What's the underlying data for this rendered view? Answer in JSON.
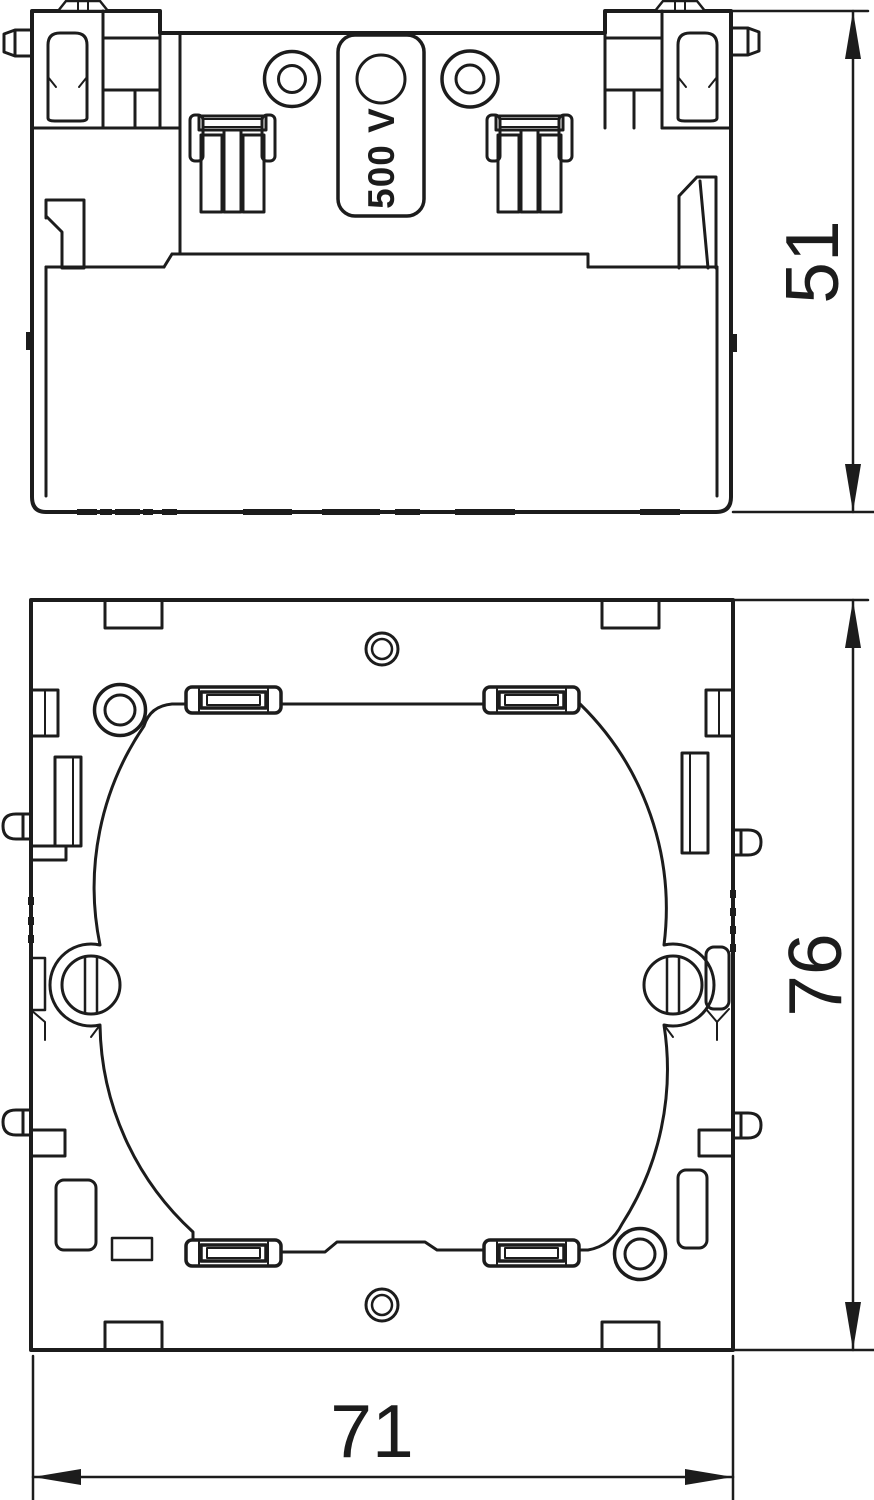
{
  "drawing": {
    "kind": "technical-dimension-drawing",
    "colors": {
      "line": "#1c1c1c",
      "background": "#ffffff"
    }
  },
  "views": {
    "side": {
      "name": "side-elevation-view",
      "voltage_label": "500 V",
      "height_dimension": "51"
    },
    "front": {
      "name": "front-plan-view",
      "height_dimension": "76",
      "width_dimension": "71"
    }
  }
}
